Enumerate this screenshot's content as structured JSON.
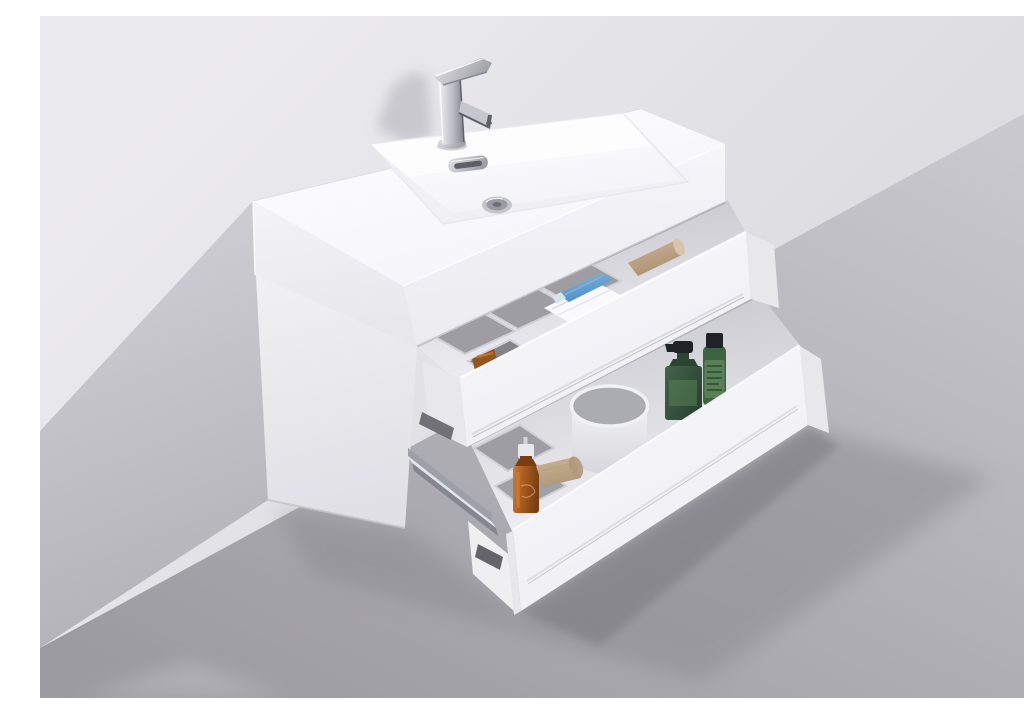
{
  "scene": {
    "type": "product-photograph",
    "subject": "White high-gloss wall-mounted floating bathroom vanity with integrated rectangular sink, chrome single-lever faucet, and two open soft-close drawers",
    "setting": "neutral gray studio wall and floor with diagonal cast shadow",
    "items": [
      {
        "name": "faucet",
        "detail": "polished chrome single-lever mixer"
      },
      {
        "name": "sink",
        "detail": "integrated acrylic basin with chrome overflow slot and pop-up drain"
      },
      {
        "name": "top-drawer-contents",
        "detail": "gray organizer trays, folded white towel, blue cosmetic tube, tan bottle, small amber jar"
      },
      {
        "name": "bottom-drawer-contents",
        "detail": "white tumbler cup, dark green pump bottle, green labeled bottle, amber pump spray bottle, tan loofah sponge"
      },
      {
        "name": "hardware",
        "detail": "gray metal telescopic drawer slide rails with dark mounting sockets"
      }
    ]
  },
  "palette": {
    "wall_top": "#ECEBEF",
    "wall_bottom": "#D8D8DD",
    "wall_shadow_light": "#D0CFD6",
    "wall_shadow_dark": "#B1B0B7",
    "floor_light": "#C9C8CE",
    "floor_dark": "#9C9BA1",
    "floor_streak": "#BCBBC1",
    "shadow_soft": "#8A8990",
    "shadow_contact": "#74737A",
    "shadow_faucet": "#B5B4BC",
    "top_hi": "#FDFDFE",
    "top_lo": "#F5F5F8",
    "front_hi": "#F7F7FA",
    "front_lo": "#EBEBF0",
    "end_hi": "#F4F4F7",
    "end_lo": "#E7E7EC",
    "cab_hi": "#F1F1F4",
    "cab_lo": "#E0E0E6",
    "slab_hi": "#FAFAFC",
    "slab_lo": "#EEEEF2",
    "slab_end": "#E7E7EC",
    "band_dark": "#C6C6CD",
    "band_light": "#F0F0F4",
    "sink_wall": "#F0F0F5",
    "sink_back": "#FDFDFE",
    "sink_floor_hi": "#FBFBFD",
    "sink_floor_lo": "#F3F3F7",
    "lip": "#EFEFF4",
    "seam": "#C4C4CB",
    "rim_bright": "#FDFDFE",
    "tray": "#9E9DA4",
    "tray_dark": "#84838A",
    "tray_rim": "#CFCFD5",
    "towel": "#FAFAFC",
    "towel_fold": "#DDDDE3",
    "tube_blue_hi": "#8AB8E0",
    "tube_blue": "#4C8DC2",
    "tube_cap": "#D7E2ED",
    "tan_hi": "#CDB297",
    "tan_lo": "#AC9173",
    "tan_cap": "#D9C4AB",
    "jar_amber": "#93551F",
    "jar_amber_hi": "#BE7530",
    "cup_hi": "#F1F1F5",
    "cup_lo": "#D6D6DC",
    "cup_in": "#ABABB2",
    "green_hi": "#46654C",
    "green_lo": "#2B4533",
    "green_label": "#587F57",
    "green_scribble": "#263B27",
    "green_body": "#3E6244",
    "cap_black": "#1F2226",
    "amber_hi": "#C87F37",
    "amber_body": "#AA5C1E",
    "amber_lo": "#7A3E12",
    "nozzle": "#E9E9ED",
    "nozzle_stem": "#D3D3D9",
    "loofah_hi": "#CBB496",
    "loofah_lo": "#AF997B",
    "loofah_line": "#B6A082",
    "rail_light": "#E3E3E9",
    "rail_mid": "#9EA0A7",
    "rail_dark": "#85878E",
    "socket": "#65646B",
    "box_white": "#EFEFF2",
    "box_side": "#E7E7EC",
    "chrome_hi": "#F3F3F5",
    "chrome_mid": "#BFC0C7",
    "chrome_dark": "#82848B",
    "chrome_edge": "#5E6067",
    "chrome_soft_hi": "#E2E2E7",
    "chrome_soft_lo": "#9FA0A7",
    "drain_outer": "#C4C4CB",
    "drain_mid": "#999AA2",
    "drain_dark": "#6E6E76",
    "spout": "#C6C7CD",
    "spout_tip": "#5F6168"
  }
}
